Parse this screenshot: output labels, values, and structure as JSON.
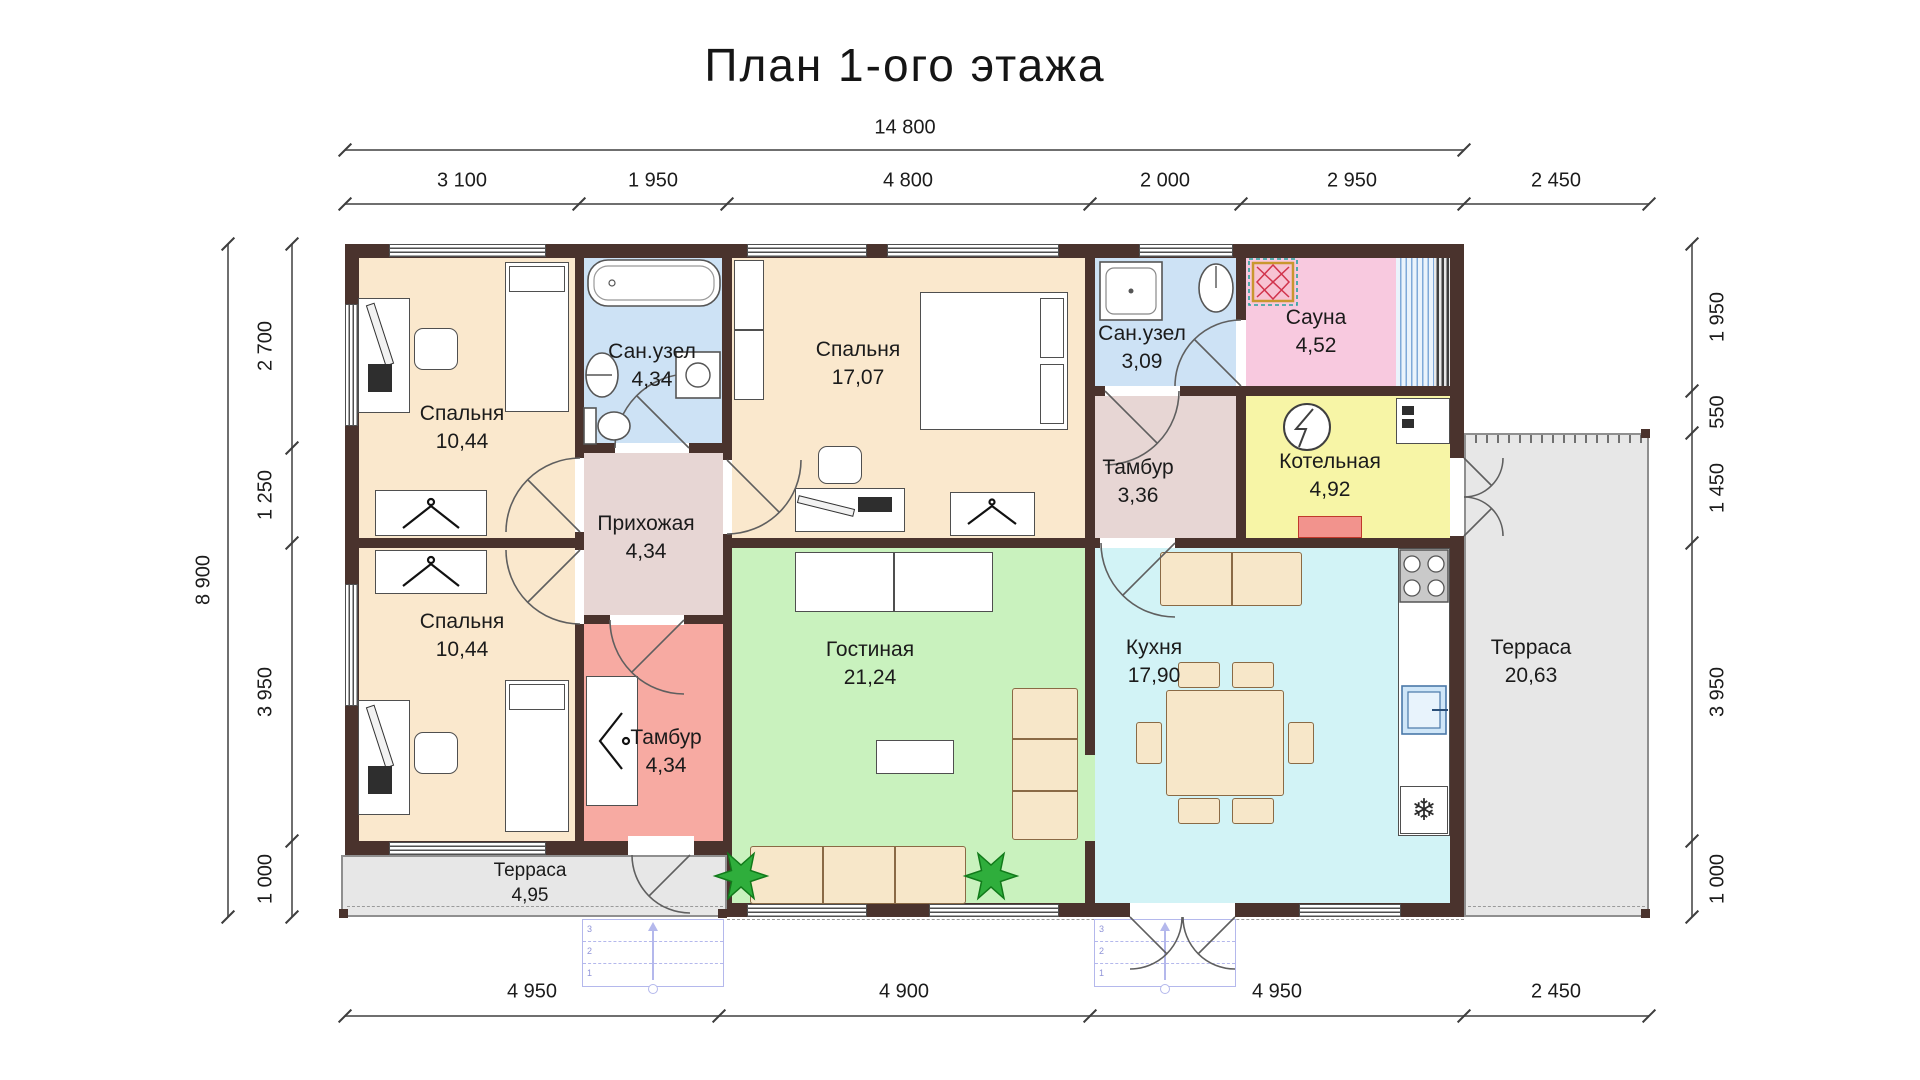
{
  "title": "План 1-ого этажа",
  "dimensions": {
    "top_total": "14 800",
    "top": [
      "3 100",
      "1 950",
      "4 800",
      "2 000",
      "2 950",
      "2 450"
    ],
    "bottom": [
      "4 950",
      "4 900",
      "4 950",
      "2 450"
    ],
    "left_total": "8 900",
    "left": [
      "2 700",
      "1 250",
      "3 950",
      "1 000"
    ],
    "right": [
      "1 950",
      "550",
      "1 450",
      "3 950",
      "1 000"
    ]
  },
  "rooms": {
    "bedroom_tl": {
      "name": "Спальня",
      "area": "10,44"
    },
    "bath_main": {
      "name": "Сан.узел",
      "area": "4,34"
    },
    "bedroom_top": {
      "name": "Спальня",
      "area": "17,07"
    },
    "bath_small": {
      "name": "Сан.узел",
      "area": "3,09"
    },
    "sauna": {
      "name": "Сауна",
      "area": "4,52"
    },
    "tambour_top": {
      "name": "Тамбур",
      "area": "3,36"
    },
    "boiler": {
      "name": "Котельная",
      "area": "4,92"
    },
    "hall": {
      "name": "Прихожая",
      "area": "4,34"
    },
    "bedroom_bl": {
      "name": "Спальня",
      "area": "10,44"
    },
    "tambour_front": {
      "name": "Тамбур",
      "area": "4,34"
    },
    "living": {
      "name": "Гостиная",
      "area": "21,24"
    },
    "kitchen": {
      "name": "Кухня",
      "area": "17,90"
    },
    "terrace_right": {
      "name": "Терраса",
      "area": "20,63"
    },
    "terrace_bottom": {
      "name": "Терраса",
      "area": "4,95"
    }
  },
  "colors": {
    "wall": "#4a332d",
    "bedroom": "#fae8cd",
    "bath": "#cde2f5",
    "sauna": "#f8c9df",
    "boiler": "#f7f5a6",
    "hall": "#e7d6d4",
    "tambour_front": "#f7aaa2",
    "living": "#c9f2be",
    "kitchen": "#d2f3f6",
    "terrace": "#e7e7e7",
    "stairs": "#b4b8ec"
  },
  "icons": {
    "fridge": "❄"
  },
  "stairs": {
    "steps": [
      "1",
      "2",
      "3"
    ]
  }
}
